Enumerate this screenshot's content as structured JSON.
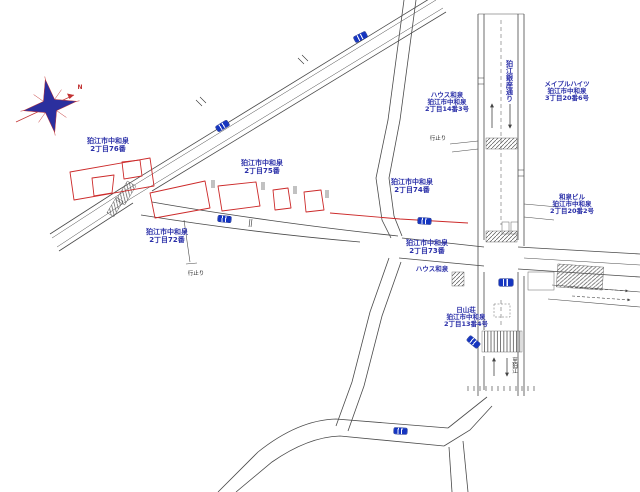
{
  "map": {
    "type": "japanese-cadastral-road-map",
    "compass": {
      "north_label": "N"
    },
    "area_labels": [
      {
        "line1": "狛江市中和泉",
        "line2": "2丁目76番"
      },
      {
        "line1": "狛江市中和泉",
        "line2": "2丁目75番"
      },
      {
        "line1": "狛江市中和泉",
        "line2": "2丁目72番"
      },
      {
        "line1": "狛江市中和泉",
        "line2": "2丁目74番"
      },
      {
        "line1": "狛江市中和泉",
        "line2": "2丁目73番"
      }
    ],
    "building_labels": [
      {
        "name": "ハウス和泉",
        "line2": "狛江市中和泉",
        "line3": "2丁目14番3号"
      },
      {
        "name": "メイプルハイツ",
        "line2": "狛江市中和泉",
        "line3": "3丁目20番6号"
      },
      {
        "name": "和泉ビル",
        "line2": "狛江市中和泉",
        "line3": "2丁目20番2号"
      },
      {
        "name": "日山荘",
        "line2": "狛江市中和泉",
        "line3": "2丁目13番4号"
      },
      {
        "name": "ハウス和泉"
      }
    ],
    "street_name_vertical": "狛江銀座通り",
    "annotations": {
      "dead_end_1": "行止り",
      "dead_end_2": "行止り",
      "direction_south": "至狛江"
    },
    "colors": {
      "parcel_red": "#cc2a2a",
      "label_blue": "#2a2fa8",
      "plate_blue": "#1535c0",
      "road_gray": "#4a4a4a",
      "compass_star": "#2b2f9e",
      "compass_needle": "#c23333"
    }
  }
}
